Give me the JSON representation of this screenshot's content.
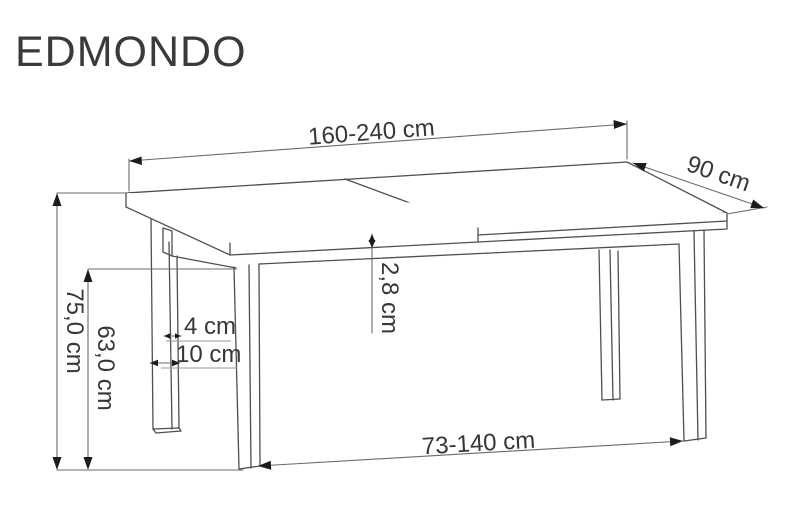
{
  "title": "EDMONDO",
  "diagram": {
    "dimensions": {
      "table_length": "160-240 cm",
      "table_depth": "90 cm",
      "table_height": "75,0 cm",
      "underframe_height": "63,0 cm",
      "top_thickness": "2,8 cm",
      "leg_width": "4 cm",
      "leg_depth": "10 cm",
      "leg_span": "73-140 cm"
    },
    "colors": {
      "background": "#ffffff",
      "drawing_line": "#4f4f4f",
      "dimension_line": "#6b6b6b",
      "leader_line": "#9a9a9a",
      "arrow": "#1c1c1c",
      "text": "#373737"
    }
  }
}
